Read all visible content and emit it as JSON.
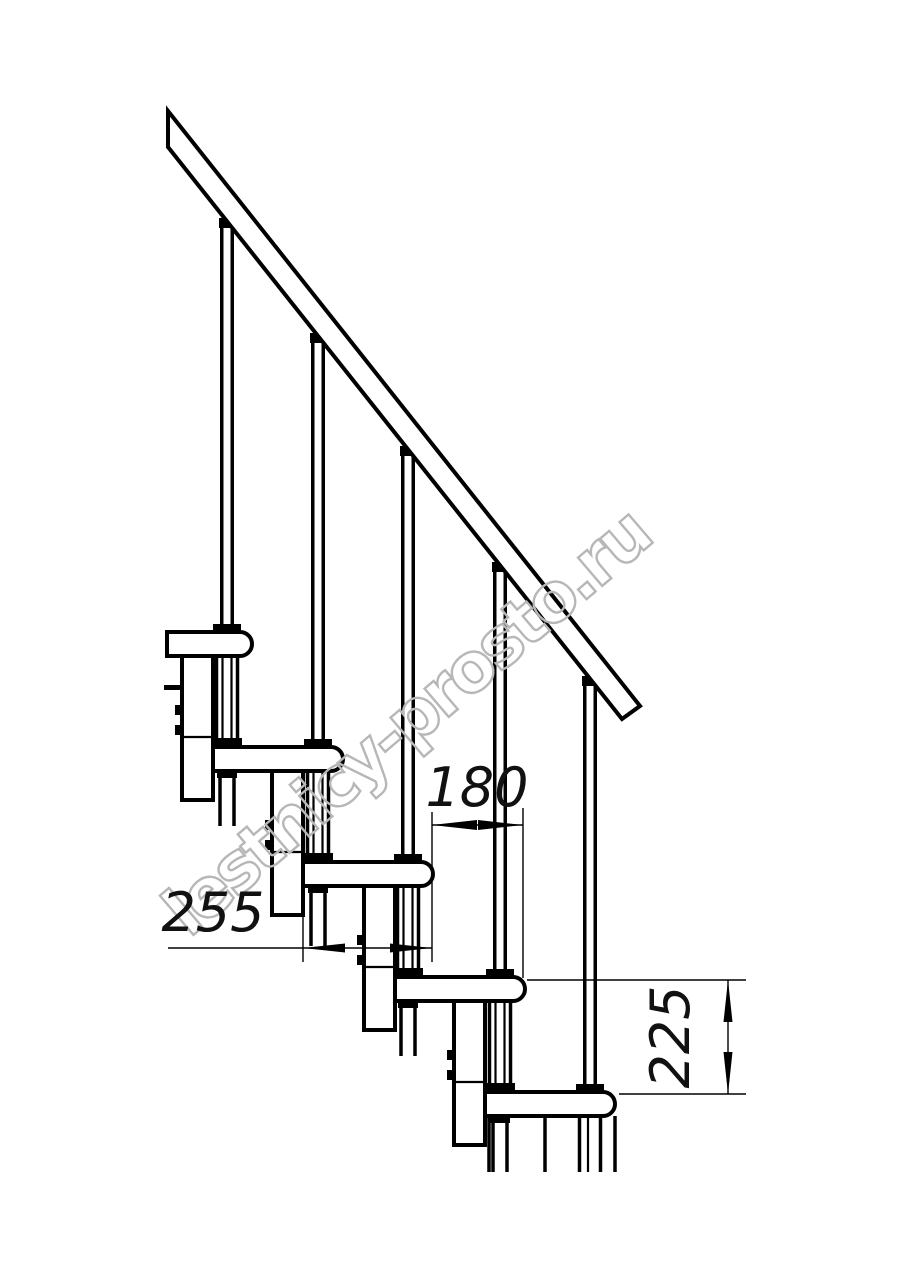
{
  "drawing": {
    "title": "modular-staircase-side-elevation",
    "watermark_text": "lestnicy-prosto.ru",
    "line_color": "#000000",
    "watermark_color": "#b7b7b7",
    "background_color": "#ffffff",
    "dimensions": {
      "going": {
        "value": "180",
        "meaning": "horizontal distance between step noses, mm"
      },
      "tread_depth": {
        "value": "255",
        "meaning": "tread depth, mm"
      },
      "rise": {
        "value": "225",
        "meaning": "vertical rise between treads, mm"
      }
    }
  }
}
